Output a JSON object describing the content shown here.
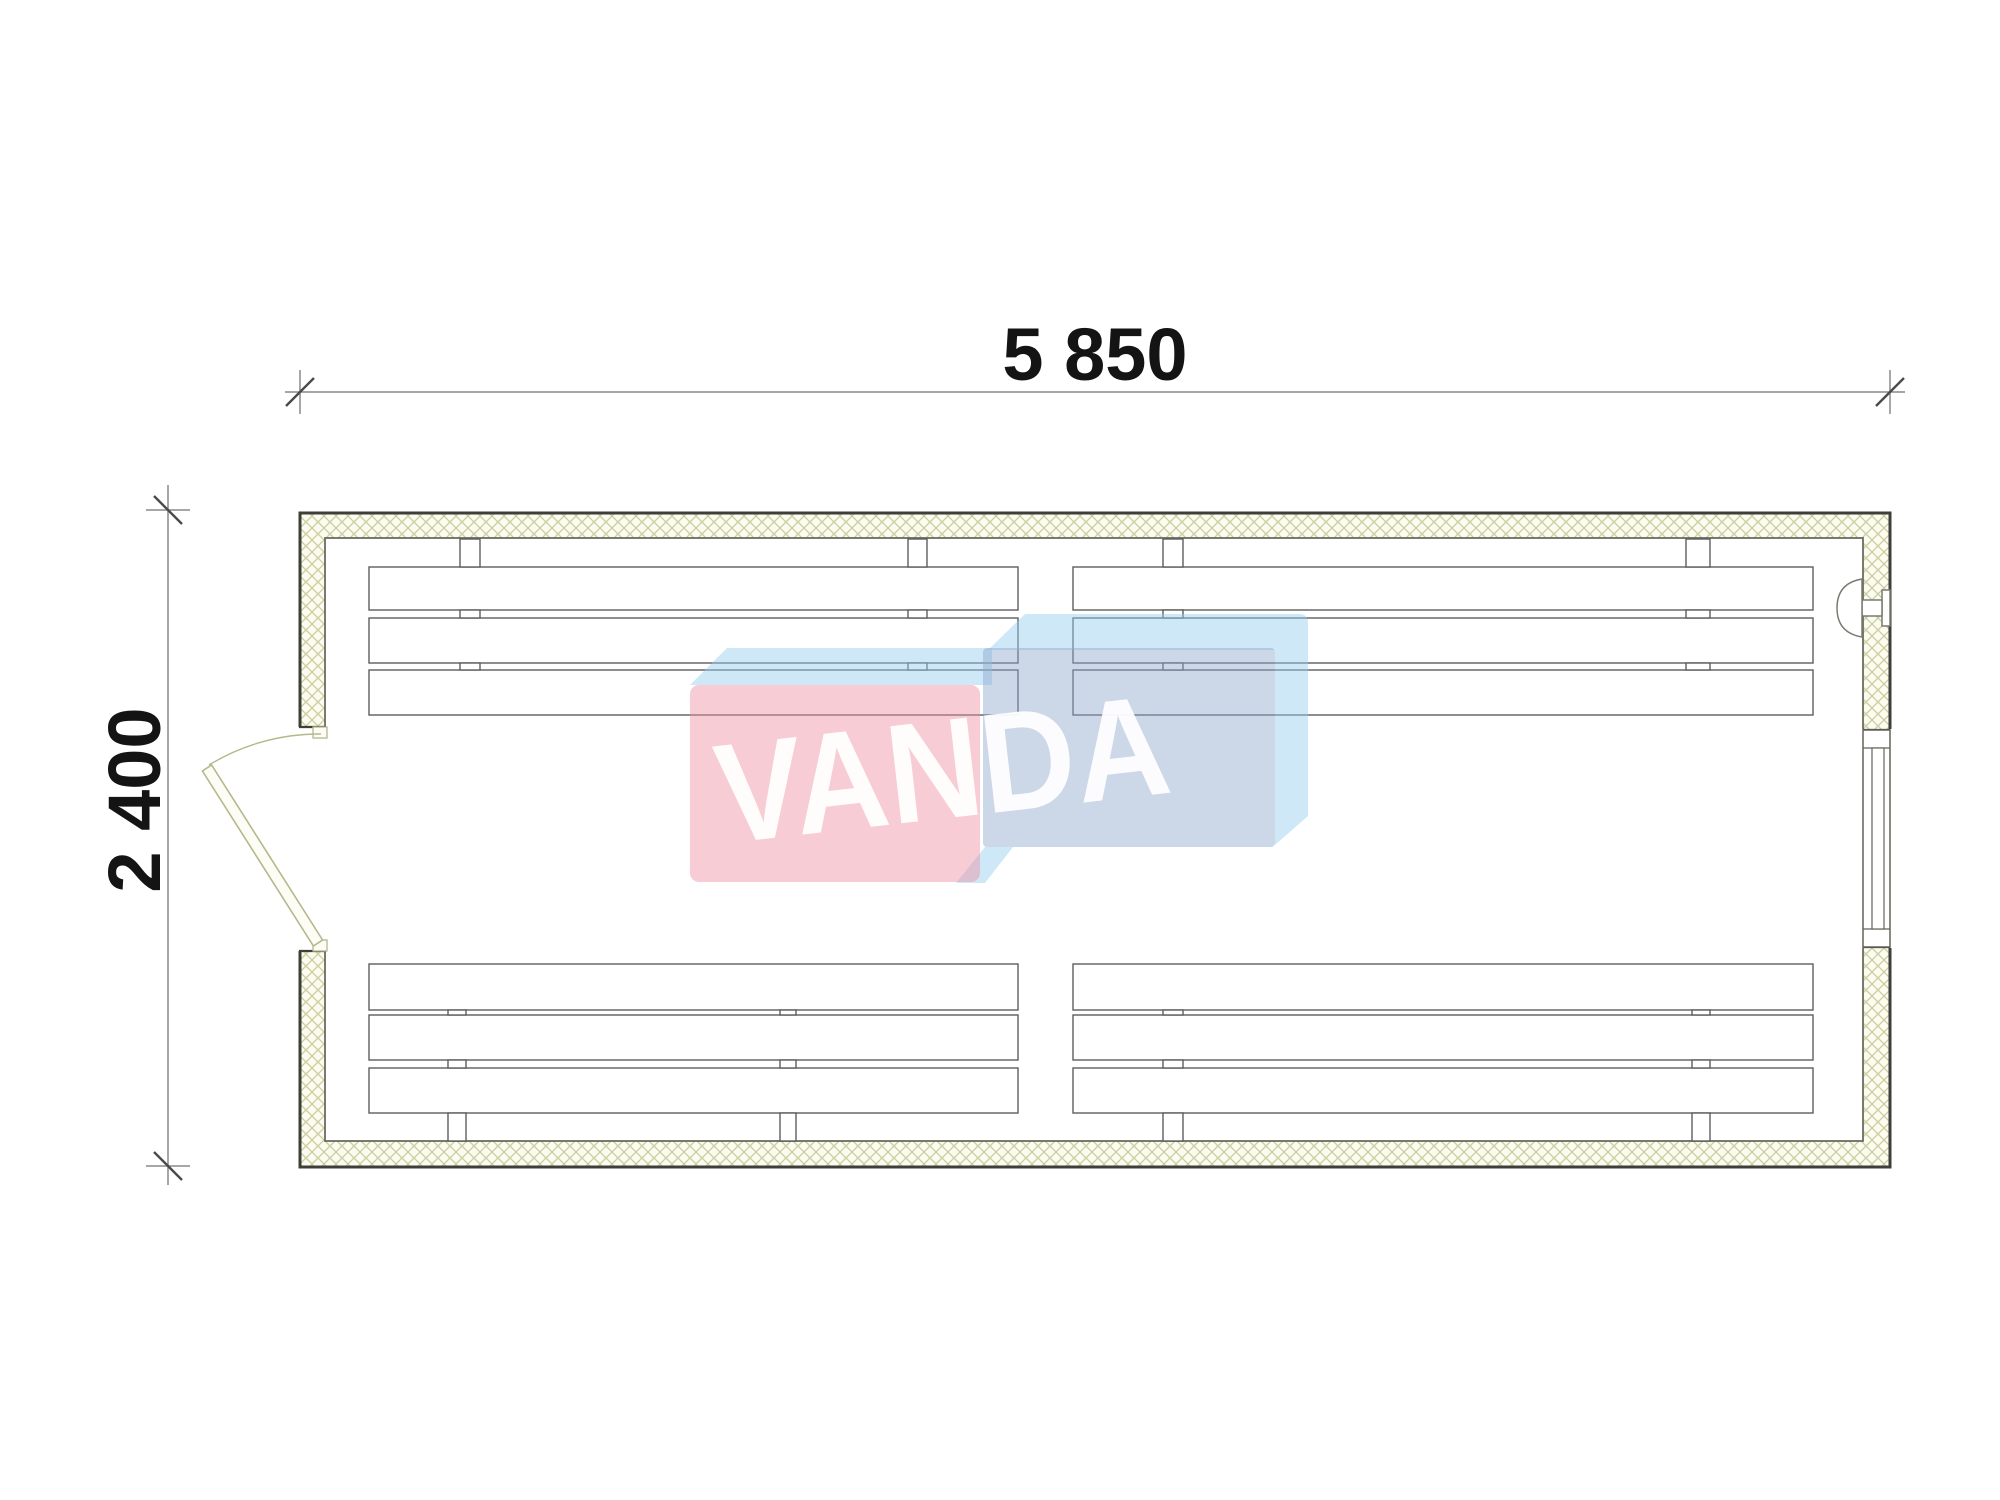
{
  "drawing": {
    "dimensions": {
      "width_label": "5 850",
      "height_label": "2 400"
    },
    "watermark": {
      "text": "VANDA"
    },
    "elements": {
      "door": "swing-door-left-wall",
      "window": "window-right-wall",
      "lamp": "wall-fixture-right",
      "benches": "four-triple-slat-bench-groups"
    }
  },
  "colors": {
    "wall_hatch": "#c8cc9d",
    "wall_fill": "#fbfbef",
    "outline_dark": "#3f3f39",
    "outline_medium": "#6c6c60",
    "bench_line": "#5d5d5d",
    "door_line": "#b5b88c",
    "dimension_line": "#8a8a8a",
    "dimension_text": "#141414",
    "logo_pink": "#ee8da0",
    "logo_light_blue": "#93cdef",
    "logo_gray_blue": "#8fa7cb",
    "logo_text": "#ffffff"
  }
}
